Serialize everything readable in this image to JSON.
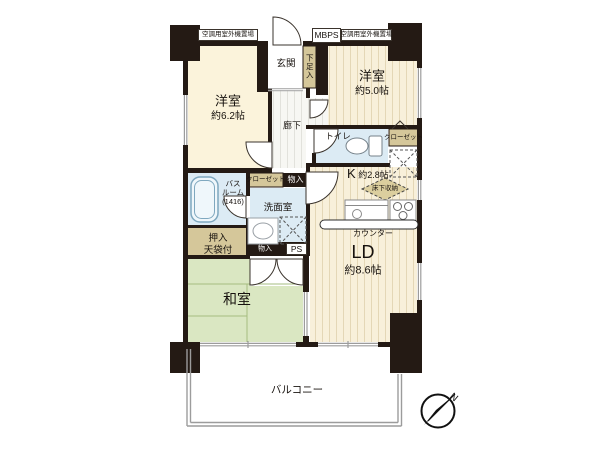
{
  "fp": {
    "exterior": {
      "aircon_left": "空調用室外機置場",
      "aircon_right": "空調用室外機置場",
      "mbps": "MBPS",
      "balcony": "バルコニー"
    },
    "rooms": {
      "genkan": "玄関",
      "hallway": "廊下",
      "west1_name": "洋室",
      "west1_size": "約6.2帖",
      "west2_name": "洋室",
      "west2_size": "約5.0帖",
      "toilet": "トイレ",
      "kitchen_name": "K",
      "kitchen_size": "約2.8帖",
      "ld_name": "LD",
      "ld_size": "約8.6帖",
      "washitsu": "和室",
      "washroom": "洗面室",
      "bath_line1": "バス",
      "bath_line2": "ルーム",
      "bath_line3": "(1416)"
    },
    "storage": {
      "shoebox": "下足入",
      "closet_hall": "クローゼット",
      "closet_west2": "クローゼット",
      "storage_hall": "物入",
      "storage_lower": "物入",
      "oshiire_line1": "押入",
      "oshiire_line2": "天袋付",
      "underfloor": "床下収納",
      "ps": "PS"
    },
    "kitchen": {
      "counter": "カウンター"
    },
    "compass": {
      "north": "N"
    },
    "colors": {
      "wall": "#241a14",
      "room_cream": "#FBF3DB",
      "flooring_stripe_bg": "#F8F0DA",
      "tatami_green": "#DAE7C2",
      "water_blue": "#DCEBF4",
      "storage_tan": "#D5C79A",
      "balcony_line": "#9C9C9C"
    }
  }
}
